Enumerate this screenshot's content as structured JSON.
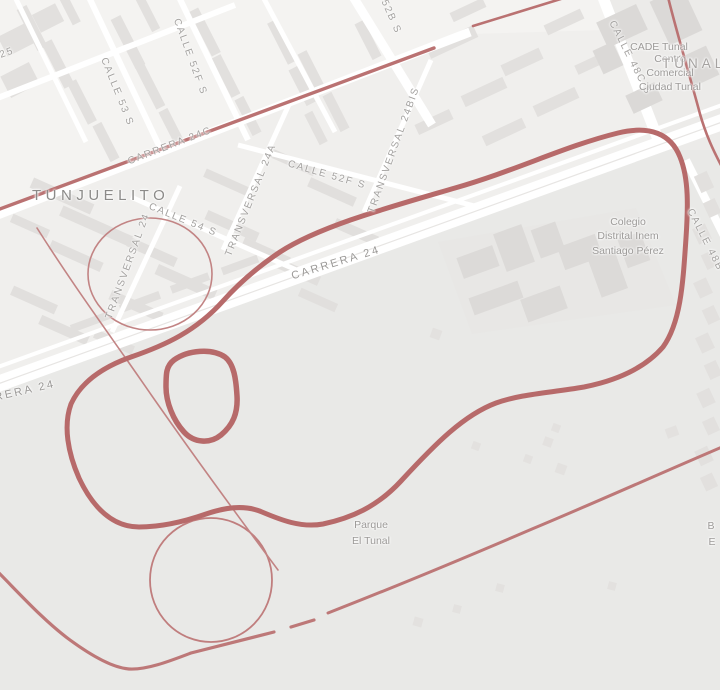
{
  "map": {
    "district": "TUNJUELITO",
    "area_label": "TÚNAL",
    "streets": {
      "carrera_24": "CARRERA 24",
      "carrera_24_partial": "RRERA 24",
      "carrera_24c": "CARRERA 24C",
      "carrera_25_partial": "25",
      "calle_52b_partial": "52B S",
      "calle_52f_upper": "CALLE 52F S",
      "calle_52f_lower": "CALLE 52F S",
      "calle_53": "CALLE 53 S",
      "calle_54": "CALLE 54 S",
      "transversal_24": "TRANSVERSAL 24",
      "transversal_24a": "TRANSVERSAL 24A",
      "transversal_24bis": "TRANSVERSAL 24BIS",
      "calle_48c": "CALLE 48C S",
      "calle_48b_partial": "CALLE 48B"
    },
    "places": {
      "cade": "CADE Tunal",
      "mall": [
        "Centro",
        "Comercial",
        "Ciudad Tunal"
      ],
      "school": [
        "Colegio",
        "Distrital Inem",
        "Santiago Pérez"
      ],
      "park": [
        "Parque",
        "El Tunal"
      ],
      "edge_partial": [
        "B",
        "E"
      ]
    },
    "colors": {
      "route_primary": "#b76a6a",
      "route_secondary": "#ba7272",
      "route_thin": "#c28484",
      "background": "#f0efed",
      "park_fill": "#e9e9e7",
      "street_fill": "#ffffff",
      "building_fill": "#e2e0de",
      "label_color": "#a3a19f",
      "district_color": "#8c8b89"
    }
  }
}
